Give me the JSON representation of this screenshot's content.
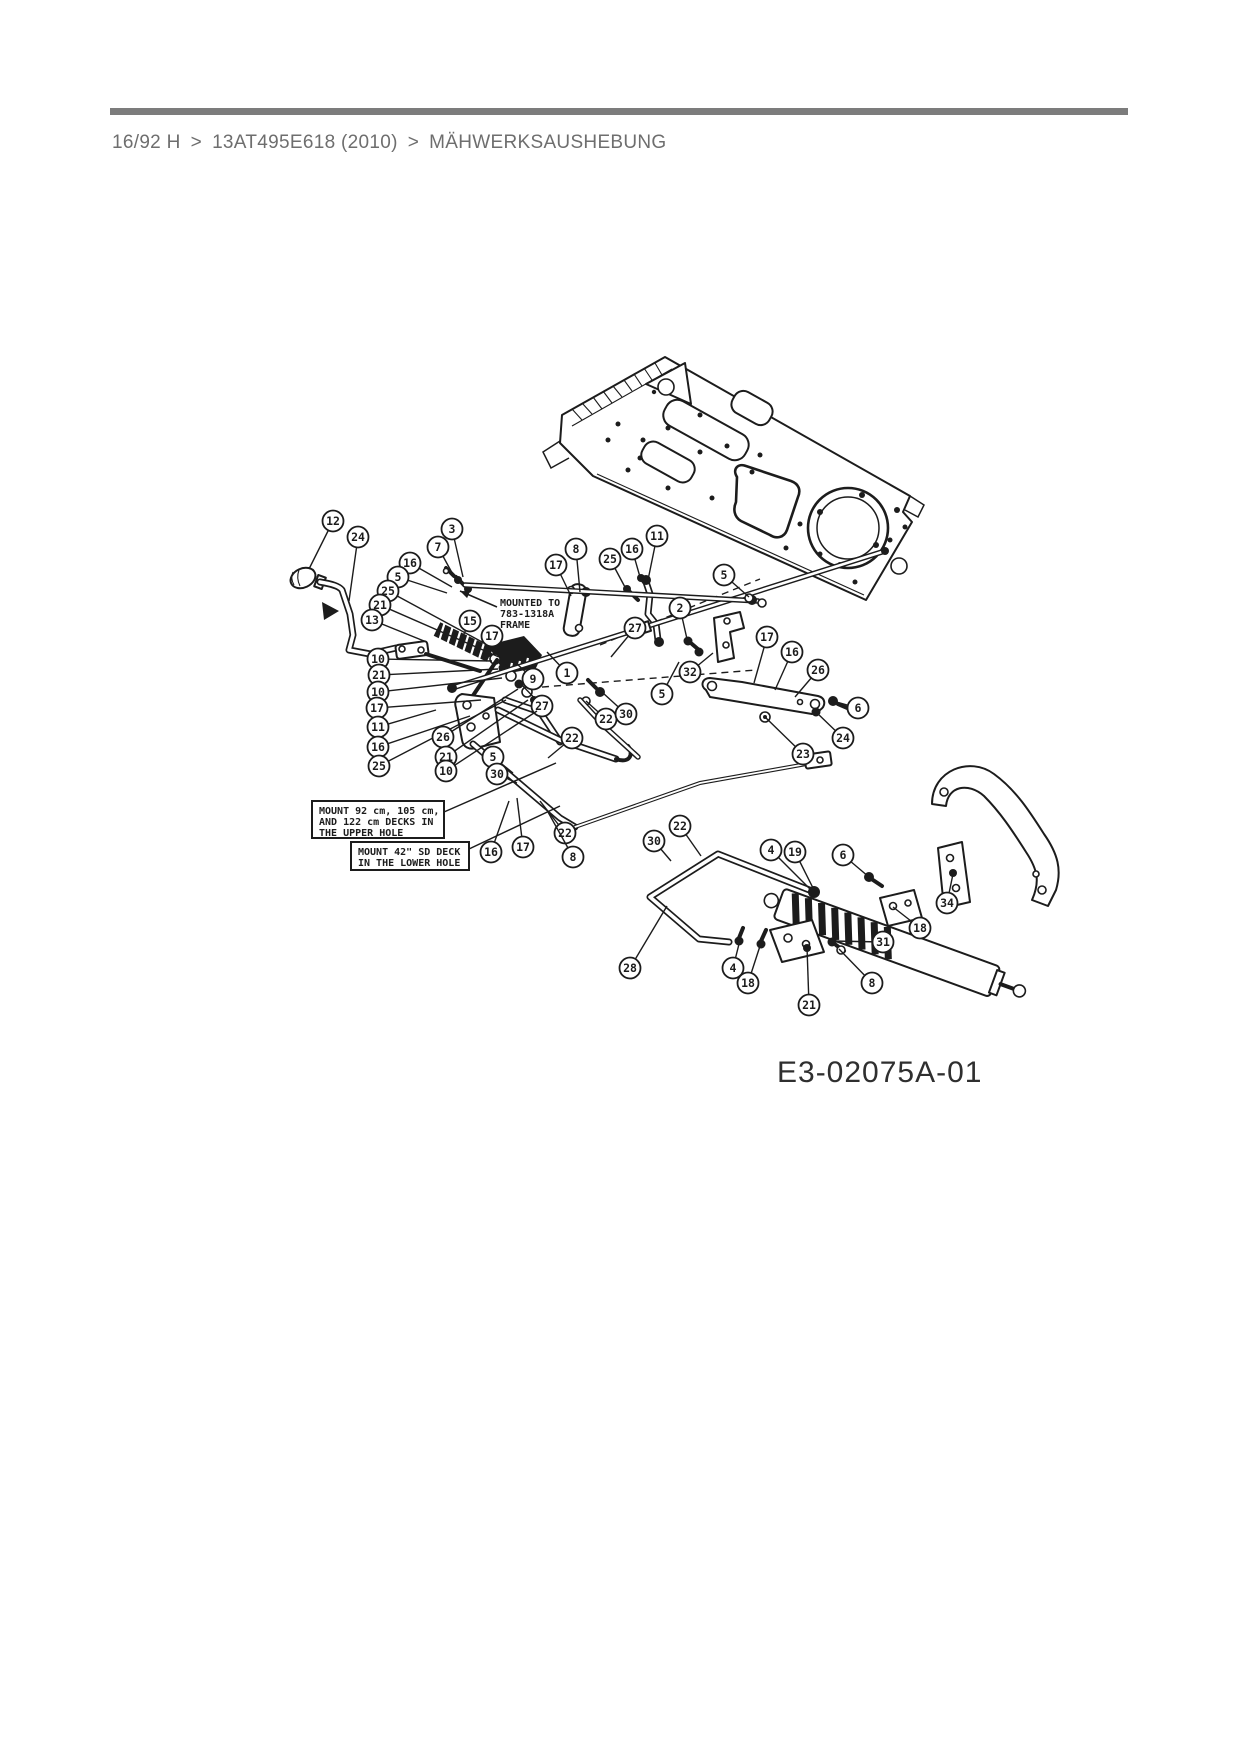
{
  "breadcrumb": {
    "separator": ">",
    "items": [
      {
        "label": "16/92 H"
      },
      {
        "label": "13AT495E618 (2010)"
      },
      {
        "label": "MÄHWERKSAUSHEBUNG"
      }
    ]
  },
  "colors": {
    "ink": "#1c1c1c",
    "paper": "#ffffff",
    "divider": "#7c7c7c",
    "breadcrumb_text": "#6e6e6e",
    "drawing_number_color": "#2f2f2f"
  },
  "diagram": {
    "drawing_number": "E3-02075A-01",
    "notes": [
      {
        "id": "frame-note",
        "boxed": false,
        "x": 500,
        "y": 598,
        "w": 66,
        "h": 34,
        "font": 10,
        "lines": [
          "MOUNTED TO",
          "783-1318A",
          "FRAME"
        ],
        "arrow": {
          "x1": 497,
          "y1": 607,
          "x2": 460,
          "y2": 591,
          "head": true
        }
      },
      {
        "id": "upper-hole-note",
        "boxed": true,
        "x": 312,
        "y": 801,
        "w": 132,
        "h": 37,
        "font": 10,
        "lines": [
          "MOUNT 92 cm, 105 cm,",
          "AND 122 cm DECKS IN",
          "THE UPPER HOLE"
        ],
        "arrow": {
          "x1": 444,
          "y1": 812,
          "x2": 556,
          "y2": 763,
          "head": false
        }
      },
      {
        "id": "lower-hole-note",
        "boxed": true,
        "x": 351,
        "y": 842,
        "w": 118,
        "h": 28,
        "font": 10,
        "lines": [
          "MOUNT 42\" SD DECK",
          "IN THE LOWER HOLE"
        ],
        "arrow": {
          "x1": 469,
          "y1": 849,
          "x2": 560,
          "y2": 806,
          "head": false
        }
      }
    ],
    "callouts": [
      {
        "n": "12",
        "x": 333,
        "y": 521,
        "tx": 309,
        "ty": 569
      },
      {
        "n": "24",
        "x": 358,
        "y": 537,
        "tx": 349,
        "ty": 601
      },
      {
        "n": "3",
        "x": 452,
        "y": 529,
        "tx": 463,
        "ty": 577
      },
      {
        "n": "7",
        "x": 438,
        "y": 547,
        "tx": 457,
        "ty": 582
      },
      {
        "n": "16",
        "x": 410,
        "y": 563,
        "tx": 452,
        "ty": 587
      },
      {
        "n": "5",
        "x": 398,
        "y": 577,
        "tx": 447,
        "ty": 593
      },
      {
        "n": "25",
        "x": 388,
        "y": 591,
        "tx": 495,
        "ty": 649
      },
      {
        "n": "21",
        "x": 380,
        "y": 605,
        "tx": 499,
        "ty": 657
      },
      {
        "n": "13",
        "x": 372,
        "y": 620,
        "tx": 424,
        "ty": 641
      },
      {
        "n": "10",
        "x": 378,
        "y": 659,
        "tx": 492,
        "ty": 661
      },
      {
        "n": "21",
        "x": 379,
        "y": 675,
        "tx": 498,
        "ty": 669
      },
      {
        "n": "10",
        "x": 378,
        "y": 692,
        "tx": 502,
        "ty": 678
      },
      {
        "n": "17",
        "x": 377,
        "y": 708,
        "tx": 481,
        "ty": 700
      },
      {
        "n": "11",
        "x": 378,
        "y": 727,
        "tx": 436,
        "ty": 710
      },
      {
        "n": "16",
        "x": 378,
        "y": 747,
        "tx": 470,
        "ty": 716
      },
      {
        "n": "25",
        "x": 379,
        "y": 766,
        "tx": 506,
        "ty": 700
      },
      {
        "n": "15",
        "x": 470,
        "y": 621,
        "tx": 463,
        "ty": 636
      },
      {
        "n": "17",
        "x": 492,
        "y": 636,
        "tx": 499,
        "ty": 656
      },
      {
        "n": "9",
        "x": 533,
        "y": 679,
        "tx": 514,
        "ty": 661
      },
      {
        "n": "1",
        "x": 567,
        "y": 673,
        "tx": 547,
        "ty": 652
      },
      {
        "n": "27",
        "x": 542,
        "y": 706,
        "tx": 521,
        "ty": 684
      },
      {
        "n": "26",
        "x": 443,
        "y": 737,
        "tx": 518,
        "ty": 689
      },
      {
        "n": "21",
        "x": 446,
        "y": 757,
        "tx": 528,
        "ty": 700
      },
      {
        "n": "10",
        "x": 446,
        "y": 771,
        "tx": 537,
        "ty": 711
      },
      {
        "n": "5",
        "x": 493,
        "y": 757,
        "tx": 513,
        "ty": 773
      },
      {
        "n": "30",
        "x": 497,
        "y": 774,
        "tx": 517,
        "ty": 783
      },
      {
        "n": "17",
        "x": 556,
        "y": 565,
        "tx": 571,
        "ty": 596
      },
      {
        "n": "8",
        "x": 576,
        "y": 549,
        "tx": 580,
        "ty": 592
      },
      {
        "n": "25",
        "x": 610,
        "y": 559,
        "tx": 626,
        "ty": 589
      },
      {
        "n": "16",
        "x": 632,
        "y": 549,
        "tx": 640,
        "ty": 577
      },
      {
        "n": "11",
        "x": 657,
        "y": 536,
        "tx": 648,
        "ty": 580
      },
      {
        "n": "5",
        "x": 724,
        "y": 575,
        "tx": 749,
        "ty": 597
      },
      {
        "n": "2",
        "x": 680,
        "y": 608,
        "tx": 687,
        "ty": 639
      },
      {
        "n": "27",
        "x": 635,
        "y": 628,
        "tx": 611,
        "ty": 657
      },
      {
        "n": "32",
        "x": 690,
        "y": 672,
        "tx": 713,
        "ty": 653
      },
      {
        "n": "5",
        "x": 662,
        "y": 694,
        "tx": 679,
        "ty": 662
      },
      {
        "n": "17",
        "x": 767,
        "y": 637,
        "tx": 754,
        "ty": 683
      },
      {
        "n": "16",
        "x": 792,
        "y": 652,
        "tx": 775,
        "ty": 690
      },
      {
        "n": "26",
        "x": 818,
        "y": 670,
        "tx": 795,
        "ty": 697
      },
      {
        "n": "6",
        "x": 858,
        "y": 708,
        "tx": 833,
        "ty": 701
      },
      {
        "n": "24",
        "x": 843,
        "y": 738,
        "tx": 816,
        "ty": 712
      },
      {
        "n": "23",
        "x": 803,
        "y": 754,
        "tx": 765,
        "ty": 717
      },
      {
        "n": "22",
        "x": 572,
        "y": 738,
        "tx": 548,
        "ty": 758
      },
      {
        "n": "22",
        "x": 606,
        "y": 719,
        "tx": 586,
        "ty": 701
      },
      {
        "n": "30",
        "x": 626,
        "y": 714,
        "tx": 603,
        "ty": 693
      },
      {
        "n": "16",
        "x": 491,
        "y": 852,
        "tx": 509,
        "ty": 801
      },
      {
        "n": "17",
        "x": 523,
        "y": 847,
        "tx": 517,
        "ty": 798
      },
      {
        "n": "22",
        "x": 565,
        "y": 833,
        "tx": 540,
        "ty": 801
      },
      {
        "n": "8",
        "x": 573,
        "y": 857,
        "tx": 548,
        "ty": 812
      },
      {
        "n": "30",
        "x": 654,
        "y": 841,
        "tx": 671,
        "ty": 861
      },
      {
        "n": "22",
        "x": 680,
        "y": 826,
        "tx": 701,
        "ty": 856
      },
      {
        "n": "4",
        "x": 771,
        "y": 850,
        "tx": 810,
        "ty": 889
      },
      {
        "n": "19",
        "x": 795,
        "y": 852,
        "tx": 816,
        "ty": 894
      },
      {
        "n": "6",
        "x": 843,
        "y": 855,
        "tx": 869,
        "ty": 877
      },
      {
        "n": "28",
        "x": 630,
        "y": 968,
        "tx": 667,
        "ty": 906
      },
      {
        "n": "4",
        "x": 733,
        "y": 968,
        "tx": 739,
        "ty": 944
      },
      {
        "n": "18",
        "x": 748,
        "y": 983,
        "tx": 760,
        "ty": 946
      },
      {
        "n": "21",
        "x": 809,
        "y": 1005,
        "tx": 807,
        "ty": 947
      },
      {
        "n": "8",
        "x": 872,
        "y": 983,
        "tx": 839,
        "ty": 949
      },
      {
        "n": "31",
        "x": 883,
        "y": 942,
        "tx": 832,
        "ty": 941
      },
      {
        "n": "18",
        "x": 920,
        "y": 928,
        "tx": 893,
        "ty": 907
      },
      {
        "n": "34",
        "x": 947,
        "y": 903,
        "tx": 953,
        "ty": 874
      }
    ]
  }
}
